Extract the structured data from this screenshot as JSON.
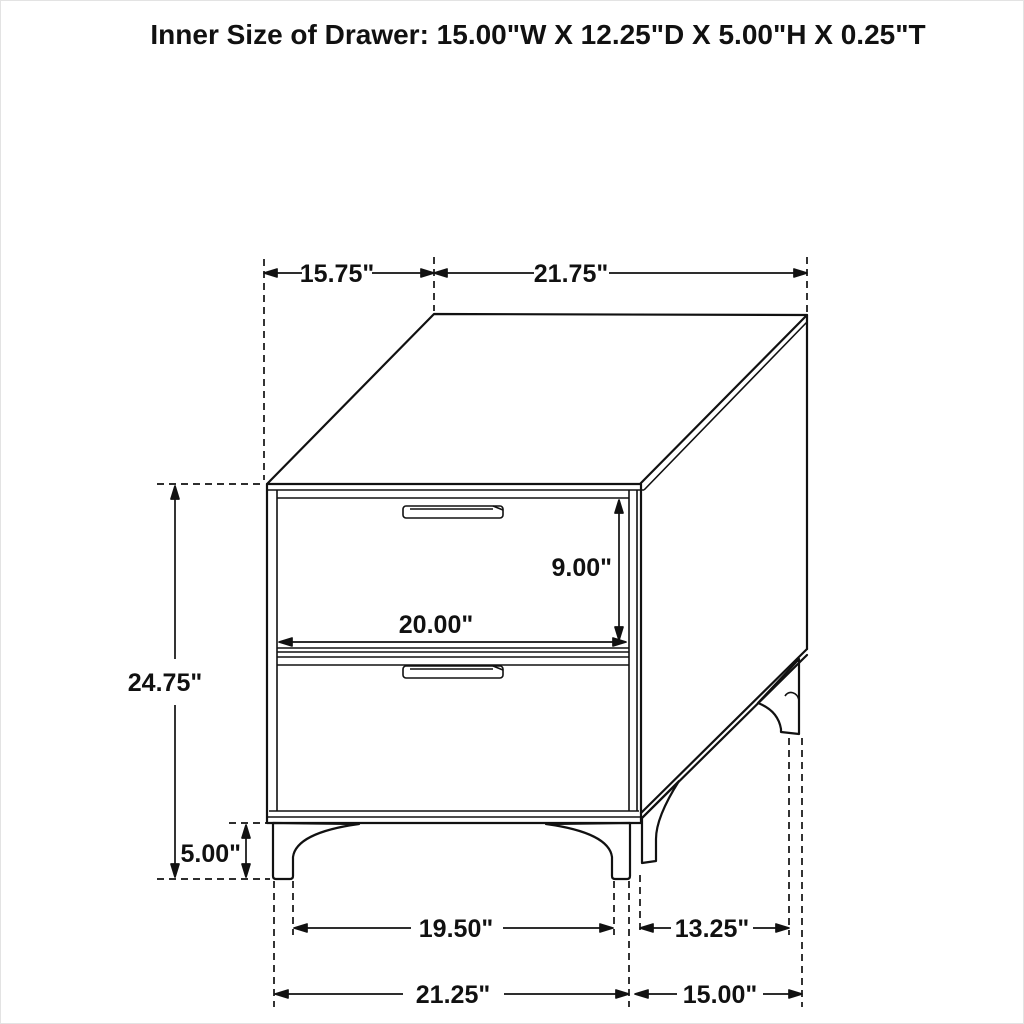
{
  "title": "Inner Size of Drawer: 15.00\"W X 12.25\"D X 5.00\"H X 0.25\"T",
  "diagram": {
    "subject": "two-drawer nightstand dimension drawing",
    "dimensions": {
      "top_depth_offset": "15.75\"",
      "top_width": "21.75\"",
      "overall_height": "24.75\"",
      "leg_height": "5.00\"",
      "drawer_opening_height": "9.00\"",
      "drawer_opening_width": "20.00\"",
      "front_leg_inner_span": "19.50\"",
      "side_leg_span": "13.25\"",
      "base_width": "21.25\"",
      "base_depth": "15.00\""
    },
    "colors": {
      "line": "#111111",
      "background": "#ffffff"
    }
  }
}
